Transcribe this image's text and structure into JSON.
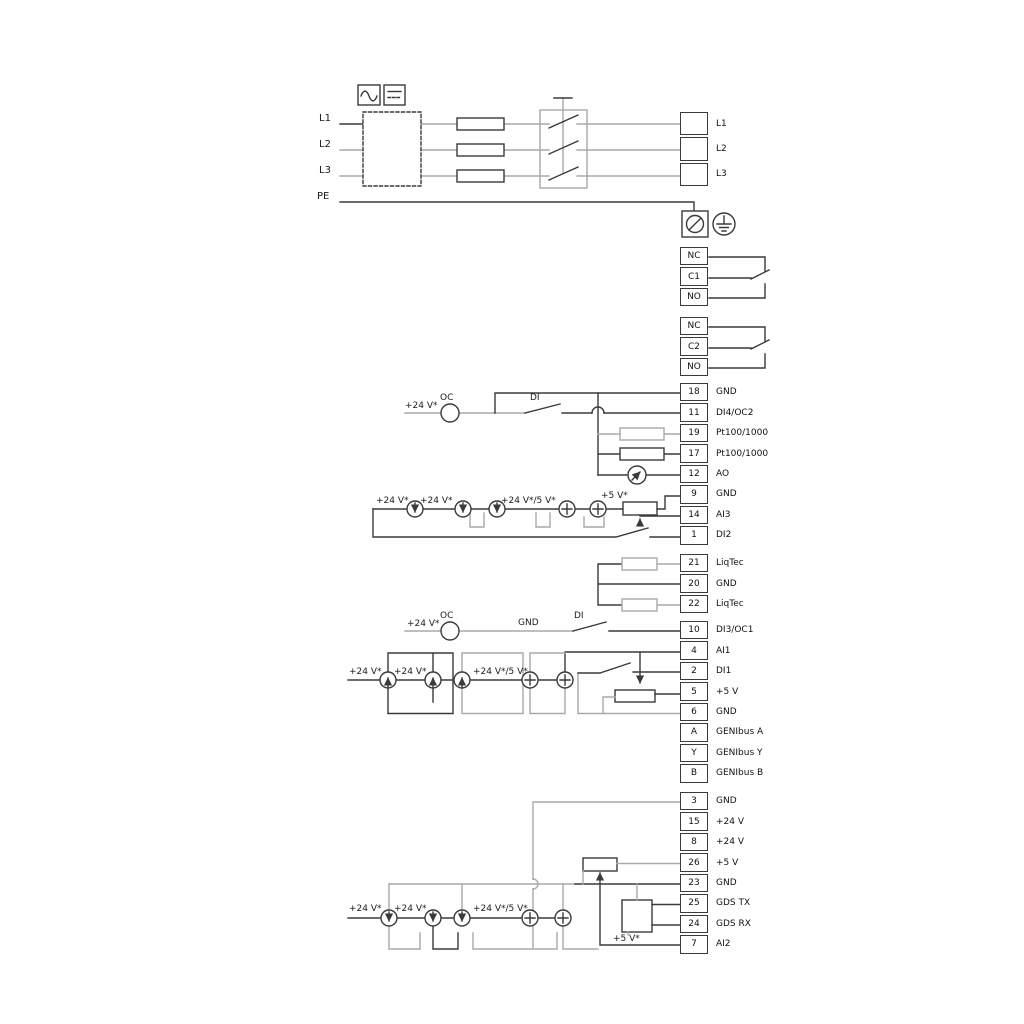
{
  "colors": {
    "wire_black": "#3a3a3a",
    "wire_gray": "#a9a9a9",
    "text": "#1c1c1c",
    "background": "#ffffff",
    "terminal_border": "#3a3a3a"
  },
  "icons": [
    "ac-sine-icon",
    "dc-icon",
    "emc-filter-box",
    "fuse",
    "disconnect-switch",
    "ground-terminal-icon",
    "pe-earth-icon",
    "oc-circle",
    "current-source-icon",
    "plus-source-icon",
    "potentiometer",
    "pt100-sensor",
    "liqtec-sensor",
    "analog-meter-icon",
    "gds-sensor-box",
    "relay-changeover-contact"
  ],
  "terminal_strips": [
    {
      "id": "mains-out",
      "x": 680,
      "y": 112,
      "w": 28,
      "rowH": 25.33,
      "rows": [
        {
          "n": "",
          "label": "L1"
        },
        {
          "n": "",
          "label": "L2"
        },
        {
          "n": "",
          "label": "L3"
        }
      ]
    },
    {
      "id": "relay1",
      "x": 680,
      "y": 247,
      "w": 28,
      "rowH": 20.4,
      "rows": [
        {
          "n": "NC"
        },
        {
          "n": "C1"
        },
        {
          "n": "NO"
        }
      ]
    },
    {
      "id": "relay2",
      "x": 680,
      "y": 317,
      "w": 28,
      "rowH": 20.4,
      "rows": [
        {
          "n": "NC"
        },
        {
          "n": "C2"
        },
        {
          "n": "NO"
        }
      ]
    },
    {
      "id": "io1",
      "x": 680,
      "y": 383,
      "w": 28,
      "rowH": 20.45,
      "rows": [
        {
          "n": "18",
          "label": "GND"
        },
        {
          "n": "11",
          "label": "DI4/OC2"
        },
        {
          "n": "19",
          "label": "Pt100/1000"
        },
        {
          "n": "17",
          "label": "Pt100/1000"
        },
        {
          "n": "12",
          "label": "AO"
        },
        {
          "n": "9",
          "label": "GND"
        },
        {
          "n": "14",
          "label": "AI3"
        },
        {
          "n": "1",
          "label": "DI2"
        }
      ]
    },
    {
      "id": "liqtec",
      "x": 680,
      "y": 554,
      "w": 28,
      "rowH": 20.45,
      "rows": [
        {
          "n": "21",
          "label": "LiqTec"
        },
        {
          "n": "20",
          "label": "GND"
        },
        {
          "n": "22",
          "label": "LiqTec"
        }
      ]
    },
    {
      "id": "io2",
      "x": 680,
      "y": 621,
      "w": 28,
      "rowH": 20.45,
      "rows": [
        {
          "n": "10",
          "label": "DI3/OC1"
        },
        {
          "n": "4",
          "label": "AI1"
        },
        {
          "n": "2",
          "label": "DI1"
        },
        {
          "n": "5",
          "label": "+5 V"
        },
        {
          "n": "6",
          "label": "GND"
        },
        {
          "n": "A",
          "label": "GENIbus A"
        },
        {
          "n": "Y",
          "label": "GENIbus Y"
        },
        {
          "n": "B",
          "label": "GENIbus B"
        }
      ]
    },
    {
      "id": "io3",
      "x": 680,
      "y": 792,
      "w": 28,
      "rowH": 20.45,
      "rows": [
        {
          "n": "3",
          "label": "GND"
        },
        {
          "n": "15",
          "label": "+24 V"
        },
        {
          "n": "8",
          "label": "+24 V"
        },
        {
          "n": "26",
          "label": "+5 V"
        },
        {
          "n": "23",
          "label": "GND"
        },
        {
          "n": "25",
          "label": "GDS TX"
        },
        {
          "n": "24",
          "label": "GDS RX"
        },
        {
          "n": "7",
          "label": "AI2"
        }
      ]
    }
  ],
  "annotations": [
    {
      "t": "L1",
      "x": 319,
      "y": 114,
      "s": 10
    },
    {
      "t": "L2",
      "x": 319,
      "y": 140,
      "s": 10
    },
    {
      "t": "L3",
      "x": 319,
      "y": 166,
      "s": 10
    },
    {
      "t": "PE",
      "x": 317,
      "y": 192,
      "s": 10
    },
    {
      "t": "+24 V*",
      "x": 405,
      "y": 402
    },
    {
      "t": "OC",
      "x": 440,
      "y": 394
    },
    {
      "t": "DI",
      "x": 530,
      "y": 394
    },
    {
      "t": "+24 V*",
      "x": 376,
      "y": 497
    },
    {
      "t": "+24 V*",
      "x": 420,
      "y": 497
    },
    {
      "t": "+24 V*/5 V*",
      "x": 501,
      "y": 497
    },
    {
      "t": "+5 V*",
      "x": 601,
      "y": 492
    },
    {
      "t": "+24 V*",
      "x": 407,
      "y": 620
    },
    {
      "t": "OC",
      "x": 440,
      "y": 612
    },
    {
      "t": "GND",
      "x": 518,
      "y": 619
    },
    {
      "t": "DI",
      "x": 574,
      "y": 612
    },
    {
      "t": "+24 V*",
      "x": 349,
      "y": 668
    },
    {
      "t": "+24 V*",
      "x": 394,
      "y": 668
    },
    {
      "t": "+24 V*/5 V*",
      "x": 473,
      "y": 668
    },
    {
      "t": "+24 V*",
      "x": 349,
      "y": 905
    },
    {
      "t": "+24 V*",
      "x": 394,
      "y": 905
    },
    {
      "t": "+24 V*/5 V*",
      "x": 473,
      "y": 905
    },
    {
      "t": "+5 V*",
      "x": 613,
      "y": 935
    }
  ]
}
